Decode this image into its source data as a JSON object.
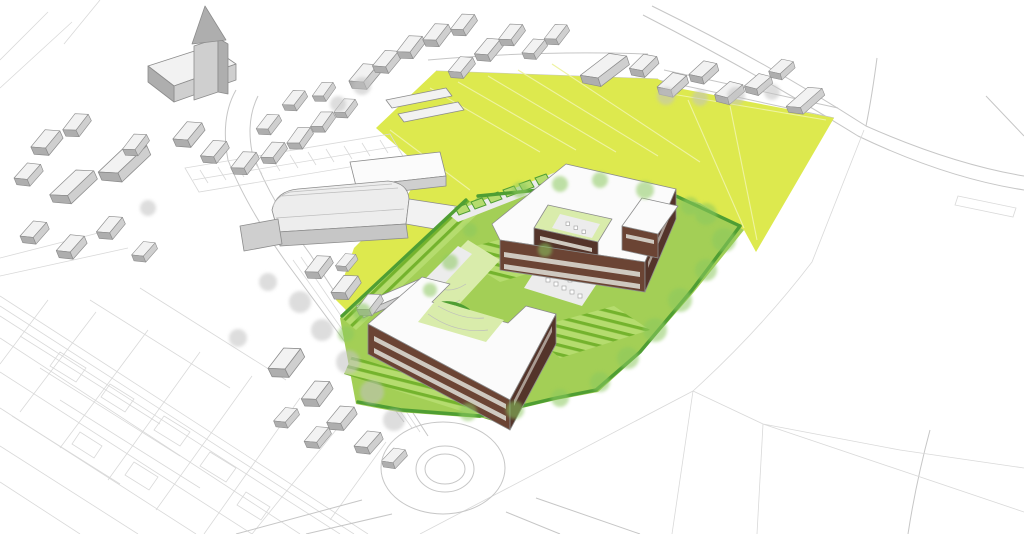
{
  "meta": {
    "width": 1024,
    "height": 534
  },
  "colors": {
    "background": "#ffffff",
    "line": "#c6c6c6",
    "parcel": "#d9d9d9",
    "line_dark": "#9c9c9c",
    "building_face": "#f2f2f2",
    "building_mid": "#cfcfcf",
    "building_dark": "#aeaeae",
    "building_stroke": "#8c8c8c",
    "roof_white": "#fbfbfb",
    "field_yellow": "#dde94e",
    "field_line": "#eef3a0",
    "site_green": "#a3cf56",
    "lawn_light": "#b5dc6e",
    "lawn_pale": "#d9ecab",
    "stripe_green": "#74b32d",
    "hedge_green": "#4f9e33",
    "tree_green": "#8cc95f",
    "tree_gray": "#c2c2c2",
    "path_gray": "#ececec",
    "facade_brown": "#6b4434",
    "facade_brown_dark": "#54342a",
    "window_band": "#cfc9c0",
    "vault_face": "#ededed",
    "vault_side": "#c6c6c6"
  },
  "scene": {
    "type": "architectural-aerial-massing-rendering",
    "elements": [
      "village-with-church-and-gray-houses",
      "church-spire",
      "parking-lot",
      "vaulted-warehouse",
      "yellow-green-farm-fields",
      "field-barn",
      "landscaped-development-site",
      "upper-courtyard-building-brown-facade-white-roof",
      "lower-courtyard-building-brown-facade-white-roof",
      "garden-stripes-and-hedges",
      "street-trees",
      "roundabout",
      "cadastral-parcel-linework",
      "curving-rural-road"
    ]
  }
}
